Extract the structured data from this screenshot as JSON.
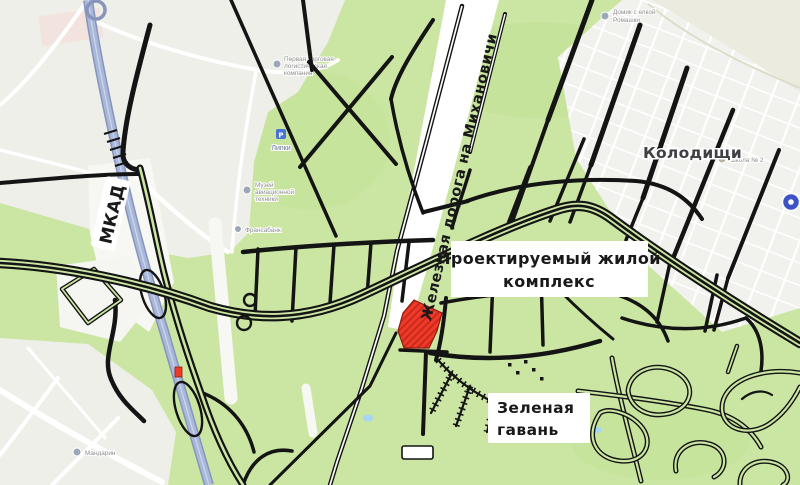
{
  "labels": {
    "mkad": "МКАД",
    "railway": "Железная дорога на Михановичи",
    "kolodishchi": "Колодищи",
    "complex_line1": "Проектируемый жилой",
    "complex_line2": "комплекс",
    "harbor_line1": "Зеленая",
    "harbor_line2": "гавань"
  },
  "pois": {
    "logistics1": "Первая торговая",
    "logistics2": "логистическая",
    "logistics3": "компания",
    "lipki": "Липки",
    "lipki_icon_glyph": "P",
    "museum1": "Музей",
    "museum2": "авиационной",
    "museum3": "техники",
    "bank": "Франсабанк",
    "mandarin": "Мандарин",
    "school": "Школа № 2",
    "izba1": "Домик с елкой",
    "izba2": "Ромашки"
  },
  "colors": {
    "land": "#cbe6a3",
    "forest": "#c0e093",
    "urban": "#edefe8",
    "village": "#f1f2ed",
    "pale": "#ecebdf",
    "road": "#141414",
    "hwyfill": "#a9b7d9",
    "hwycase": "#8794bb",
    "water": "#a6d5f5",
    "parcel": "#ee3a28",
    "parcelhatch": "#c5271a",
    "cluster": "#3d53c5",
    "labelbg": "#ffffff"
  }
}
